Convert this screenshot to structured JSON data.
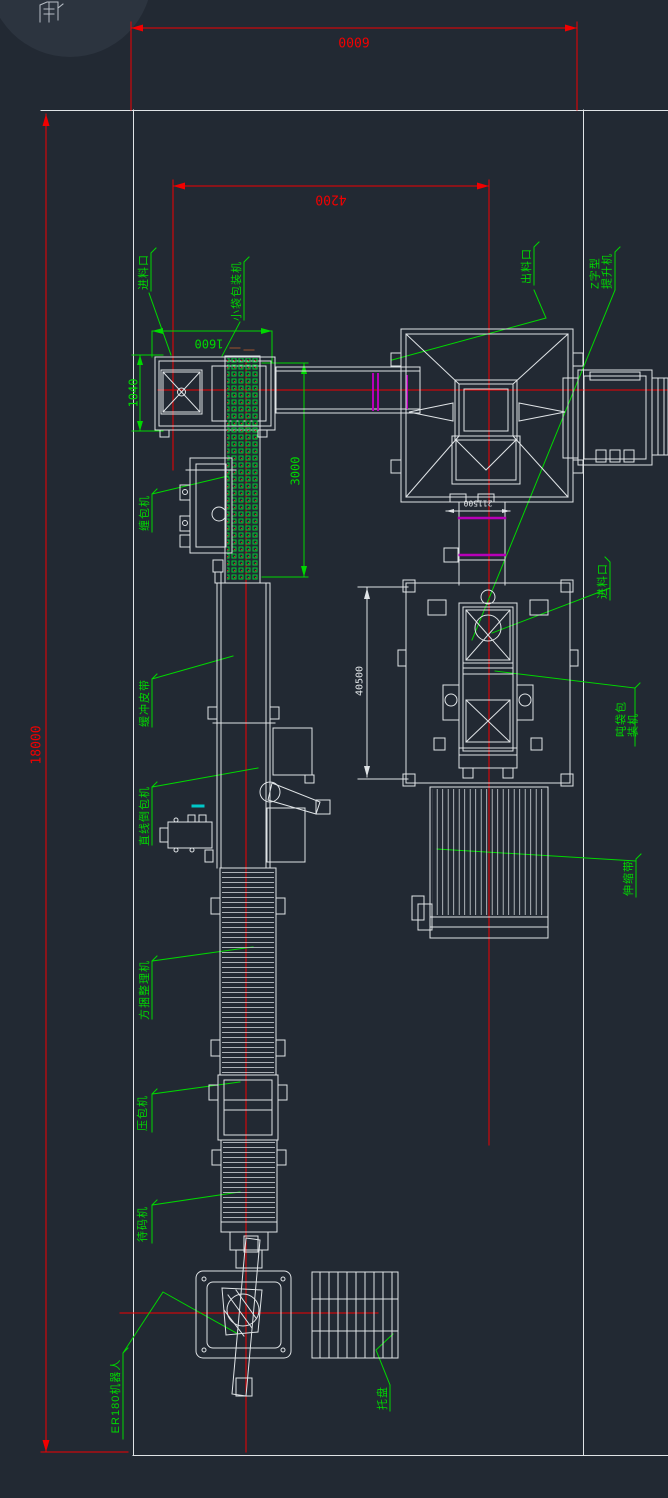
{
  "drawing": {
    "background": "#222933",
    "colors": {
      "line": "#dfe3e6",
      "dimension_red": "#f20000",
      "annotation_green": "#00d800",
      "accent_magenta": "#b800b8",
      "accent_cyan": "#00c8c8"
    }
  },
  "dims": {
    "d6000": "6000",
    "d4200": "4200",
    "d18000": "18000",
    "d1600": "1600",
    "d1040": "1040",
    "d3000": "3000",
    "d40500": "40500",
    "d211500": "211500"
  },
  "labels": {
    "inlet_left": "进料口",
    "small_bag_machine": "小袋包装机",
    "outlet": "出料口",
    "z_elevator": "Z字型\n提升机",
    "wrap_machine": "缠包机",
    "buffer_belt": "缓冲皮带",
    "line_bag_machine": "直线倒包机",
    "bale_arranger": "方捆整理机",
    "bag_press": "压包机",
    "staging_machine": "待码机",
    "robot": "ER180机器人",
    "pallet": "托盘",
    "inlet_right": "进料口",
    "ton_bag_machine": "吨袋包装机",
    "telescopic_belt": "伸缩带"
  }
}
